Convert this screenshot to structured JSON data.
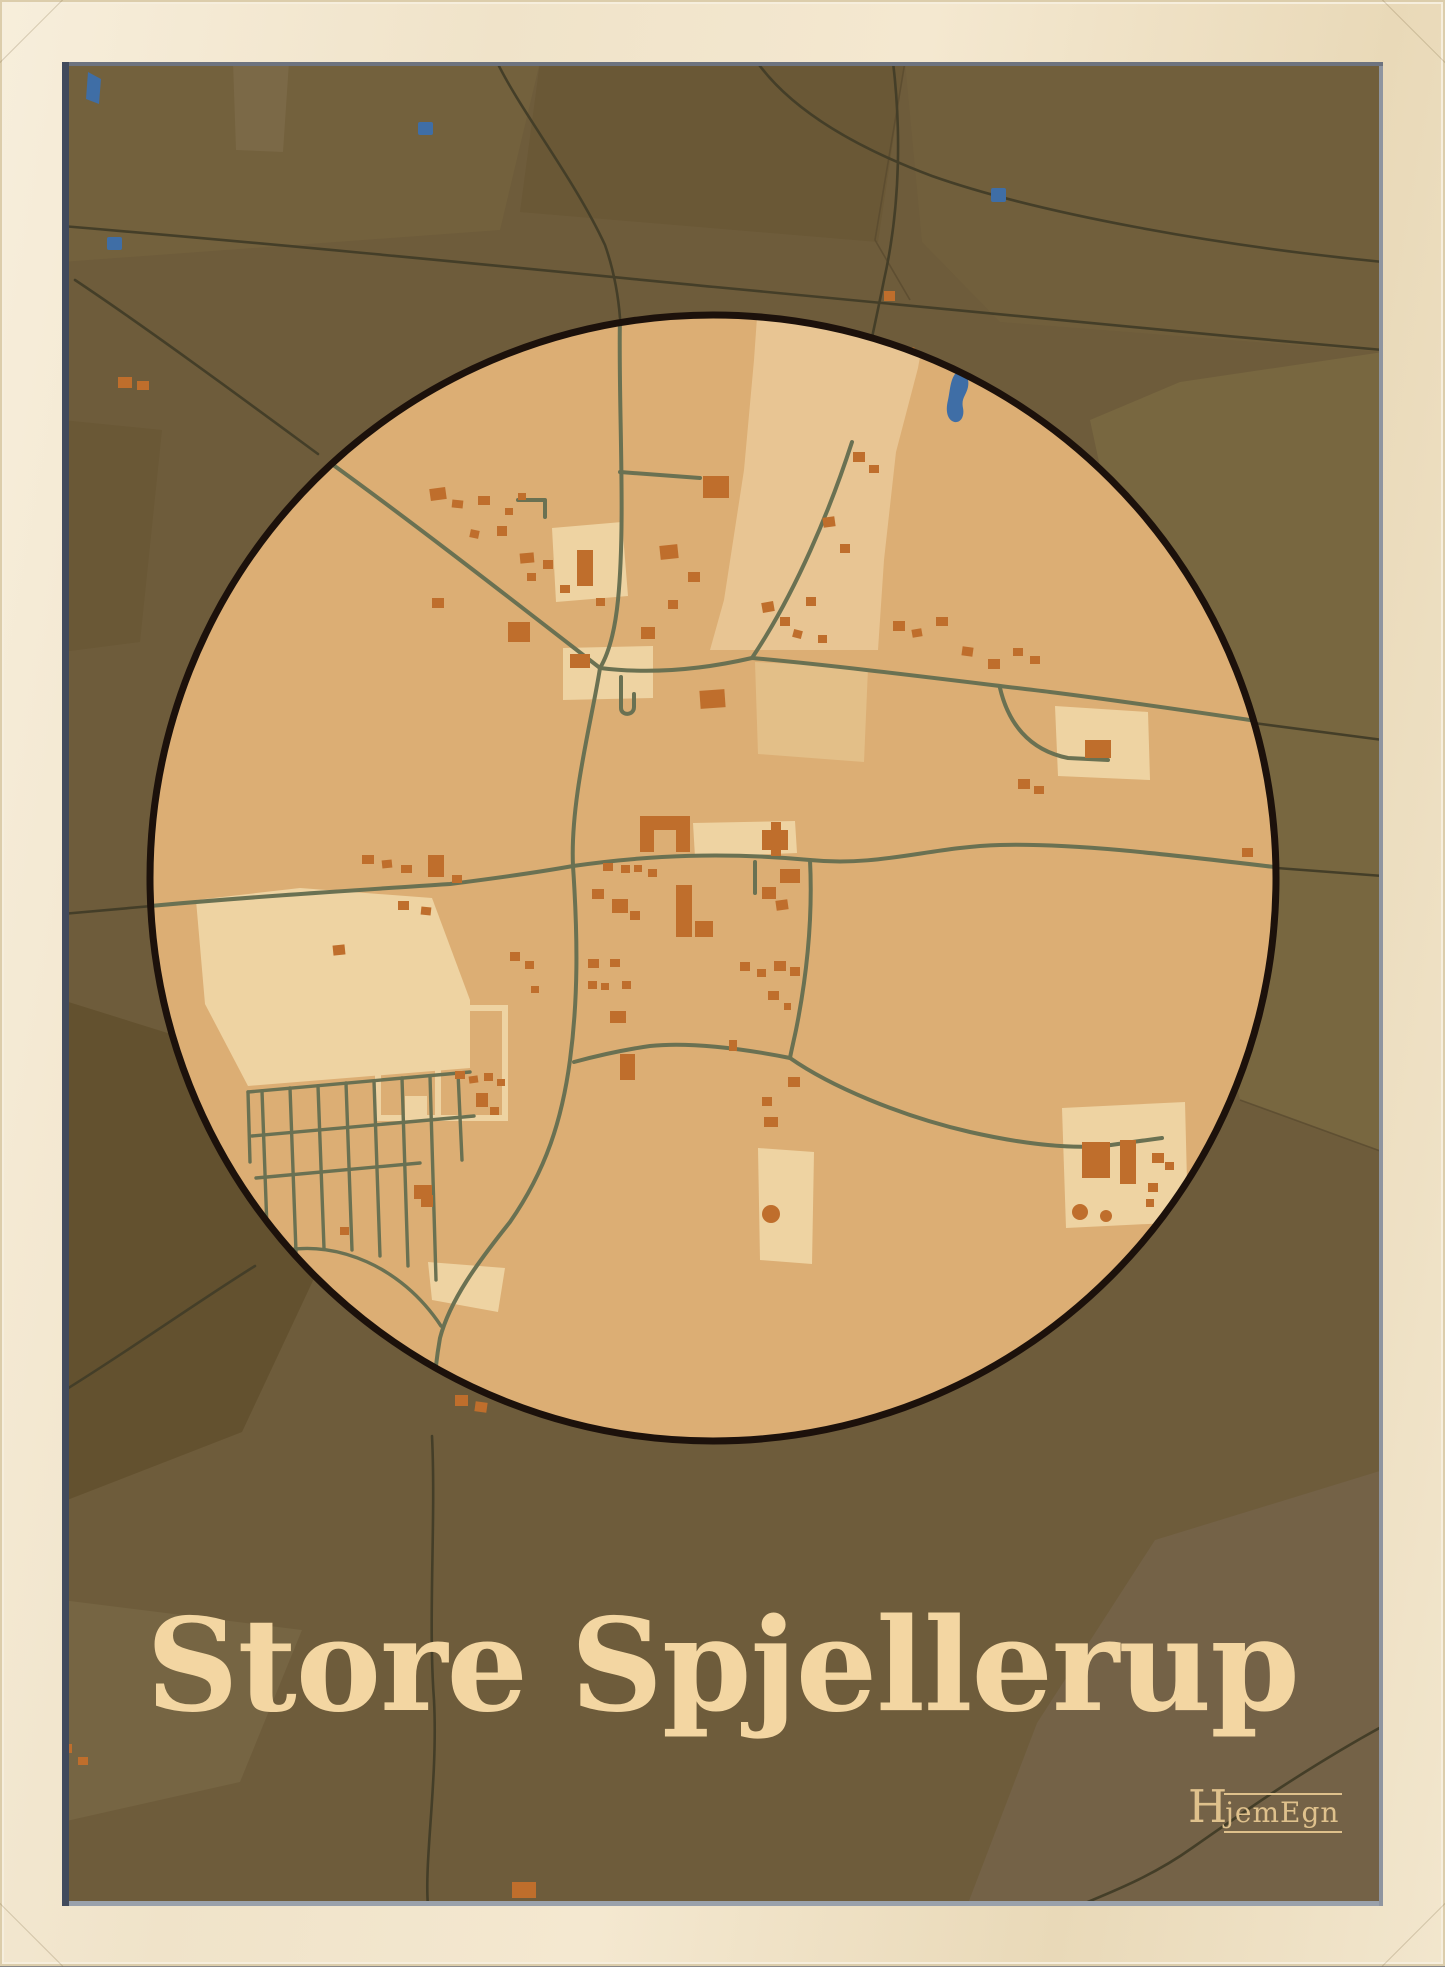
{
  "poster": {
    "title": "Store Spjellerup",
    "brand": {
      "initial": "H",
      "rest": "jemEgn"
    },
    "map_subject": "town map poster with circular focus",
    "palette": {
      "frame": "#f0e3c9",
      "outer": "#6e5c3b",
      "circle": "#dcae74",
      "rim": "#1c110b",
      "light": "#e8c593",
      "cream": "#eed3a2",
      "road_in": "#6a7152",
      "road_out": "#443e28",
      "building": "#bf6e2c",
      "water": "#3f6ea6",
      "title": "#f3d6a2",
      "logo": "#dfc18c"
    }
  }
}
